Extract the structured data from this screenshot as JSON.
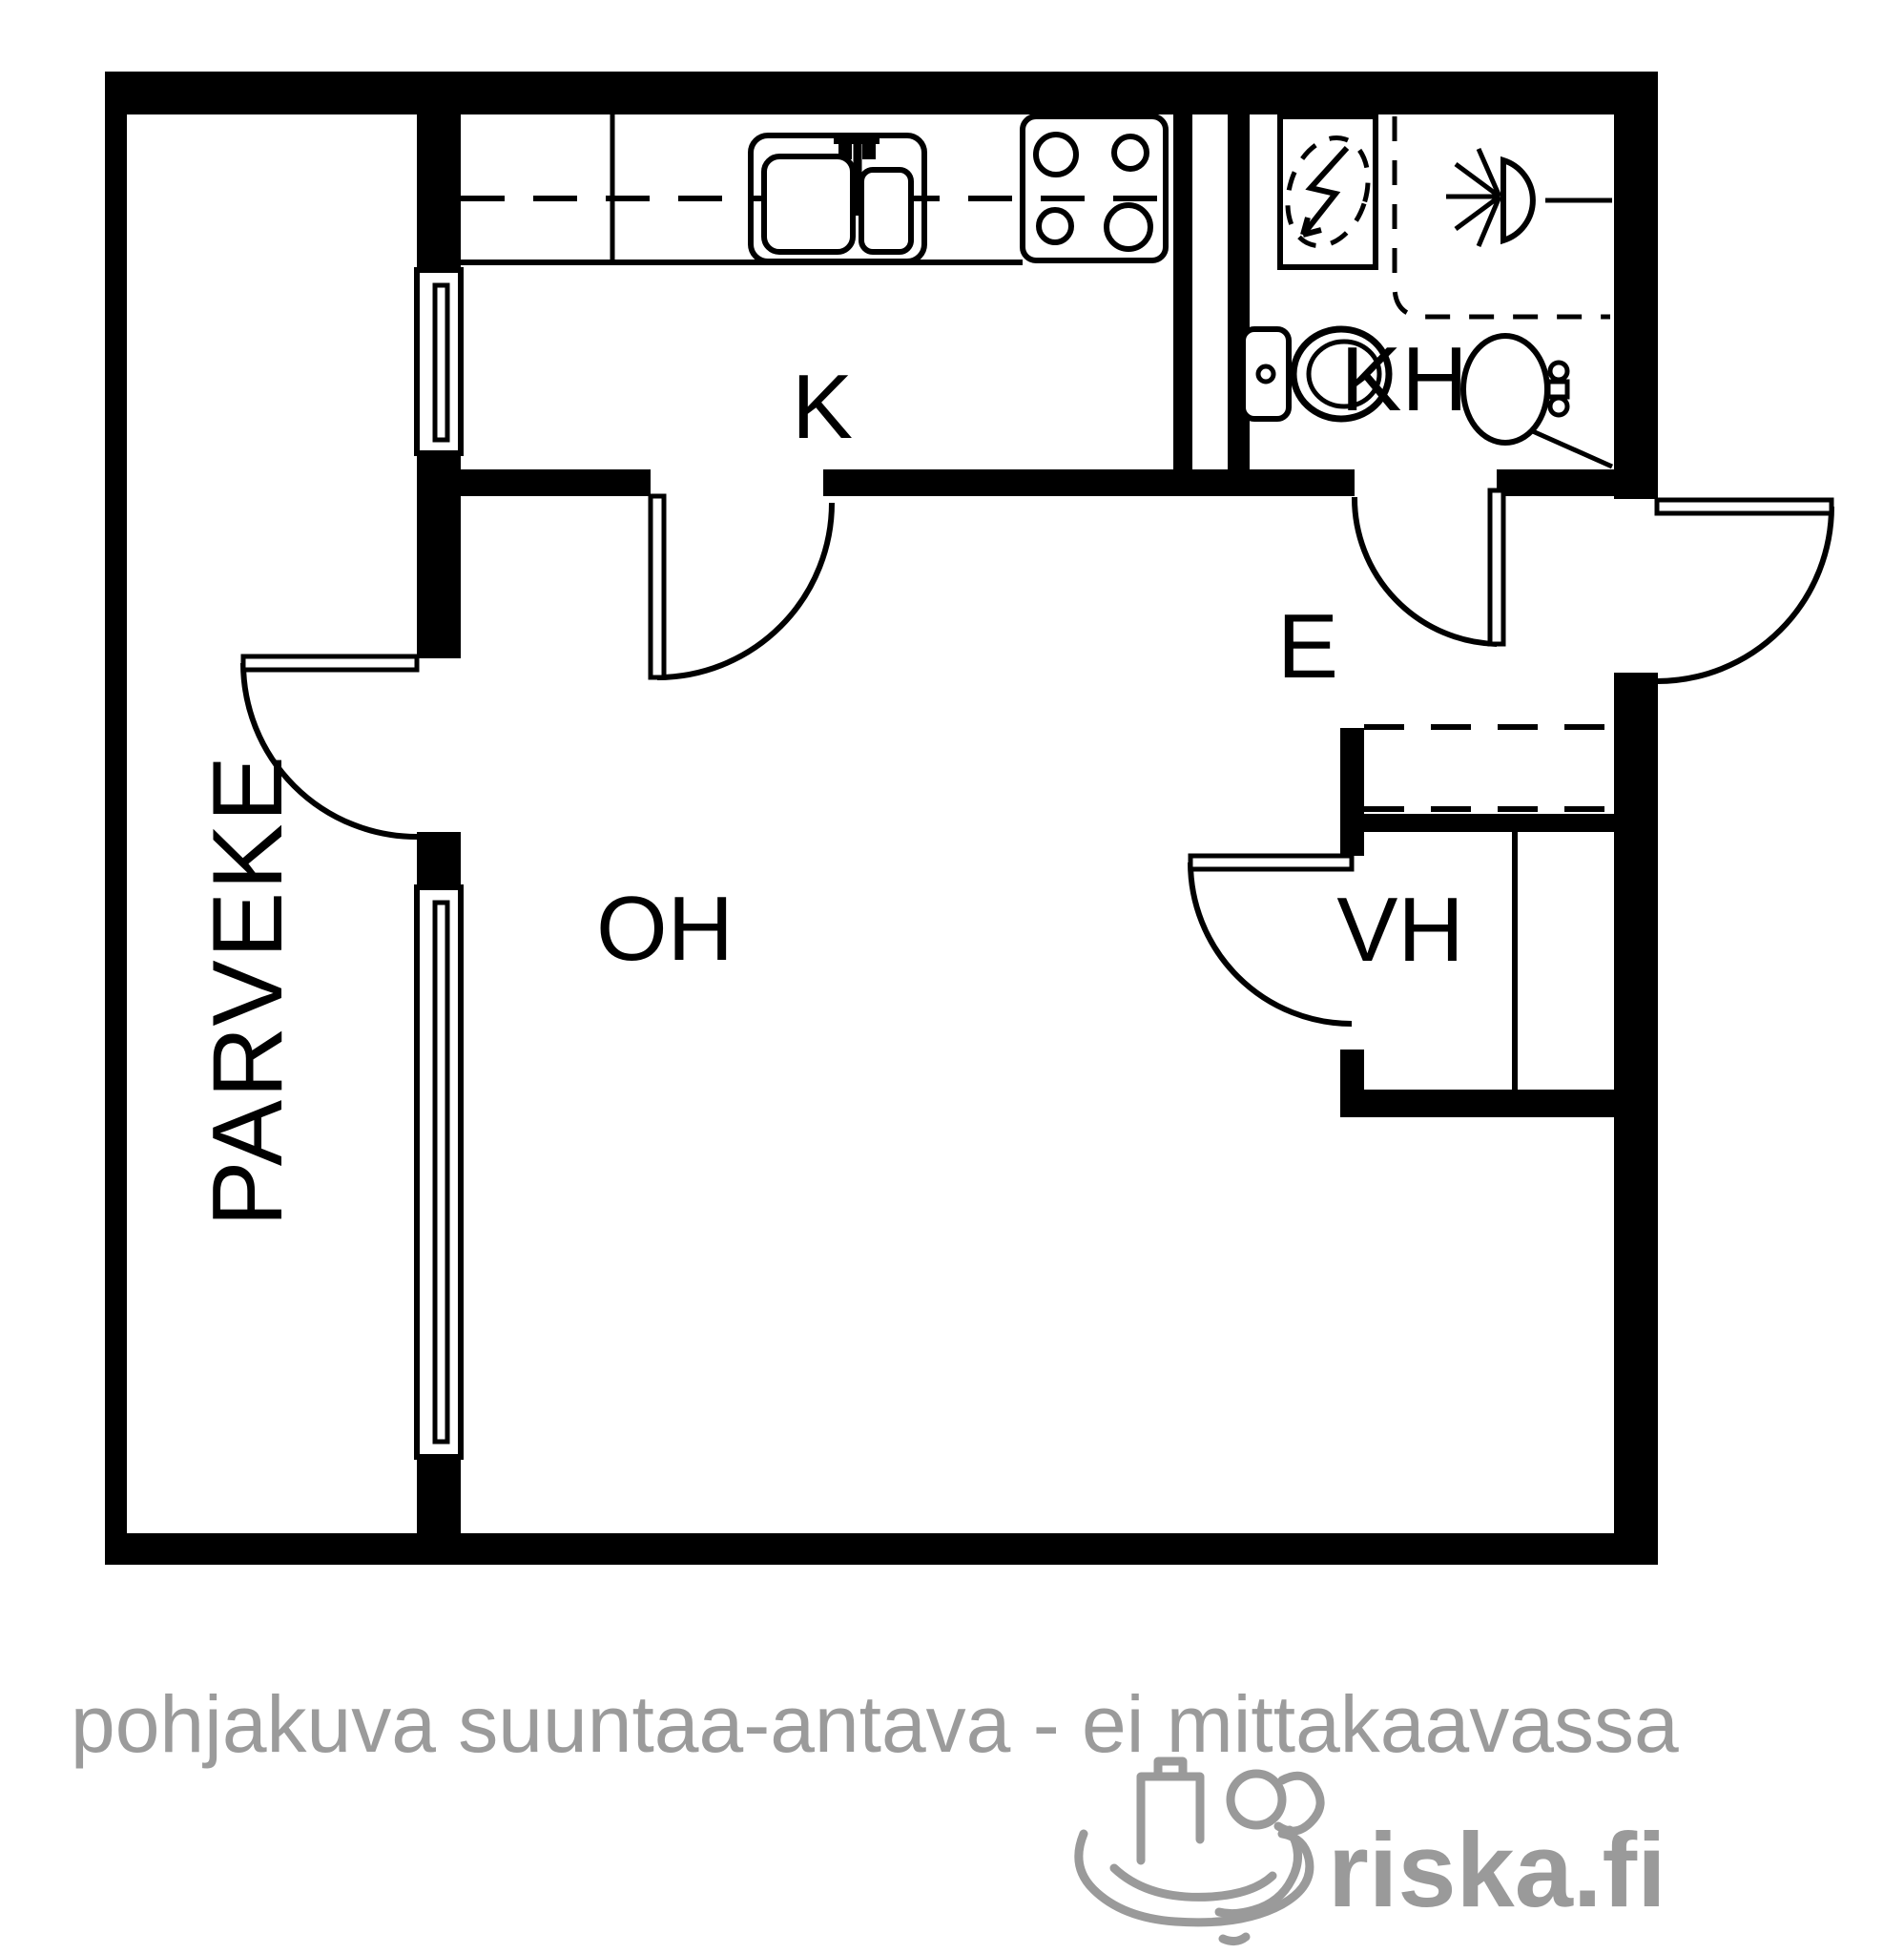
{
  "floor_plan": {
    "rooms": [
      {
        "label": "K",
        "name": "kitchen"
      },
      {
        "label": "KH",
        "name": "bathroom"
      },
      {
        "label": "E",
        "name": "entrance-hall"
      },
      {
        "label": "VH",
        "name": "walk-in-closet"
      },
      {
        "label": "OH",
        "name": "living-room"
      },
      {
        "label": "PARVEKE",
        "name": "balcony"
      }
    ],
    "windows": [
      "kitchen-balcony-window",
      "living-room-balcony-window"
    ],
    "doors": [
      "balcony-door",
      "kitchen-door",
      "bathroom-door",
      "front-door",
      "closet-door"
    ],
    "fixtures": [
      "kitchen-counter",
      "upper-cabinet-dashed-line",
      "kitchen-sink",
      "stove",
      "washing-machine-reservation",
      "shower",
      "toilet",
      "washbasin",
      "wardrobe-reservation-dashed",
      "closet-shelf-divider"
    ],
    "colors": {
      "walls": "#000000",
      "background": "#ffffff",
      "footer_text": "#9b9b9b",
      "watermark": "#9a9a9a"
    }
  },
  "footer": {
    "disclaimer": "pohjakuva suuntaa-antava - ei mittakaavassa"
  },
  "watermark": {
    "brand": "riska.fi"
  }
}
